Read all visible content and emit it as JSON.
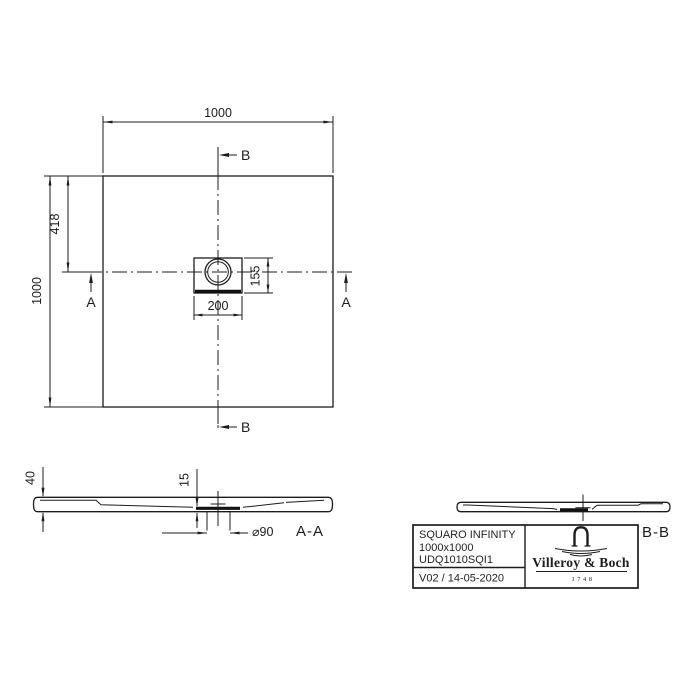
{
  "plan": {
    "dim_top_width": "1000",
    "dim_left_height": "1000",
    "dim_drain_center_from_top": "418",
    "dim_drain_box_width": "200",
    "dim_drain_box_height": "155",
    "section_marker_a": "A",
    "section_marker_b": "B"
  },
  "section_aa": {
    "label": "A-A",
    "dim_total_height": "40",
    "dim_base_thickness": "15",
    "dim_drain_diameter": "⌀90"
  },
  "section_bb": {
    "label": "B-B"
  },
  "title_block": {
    "product_line": "SQUARO INFINITY",
    "dimensions": "1000x1000",
    "article_number": "UDQ1010SQI1",
    "version_date": "V02 / 14-05-2020",
    "brand_name": "Villeroy & Boch",
    "brand_founded": "1748"
  },
  "colors": {
    "line": "#1c1c1c",
    "background": "#ffffff"
  }
}
